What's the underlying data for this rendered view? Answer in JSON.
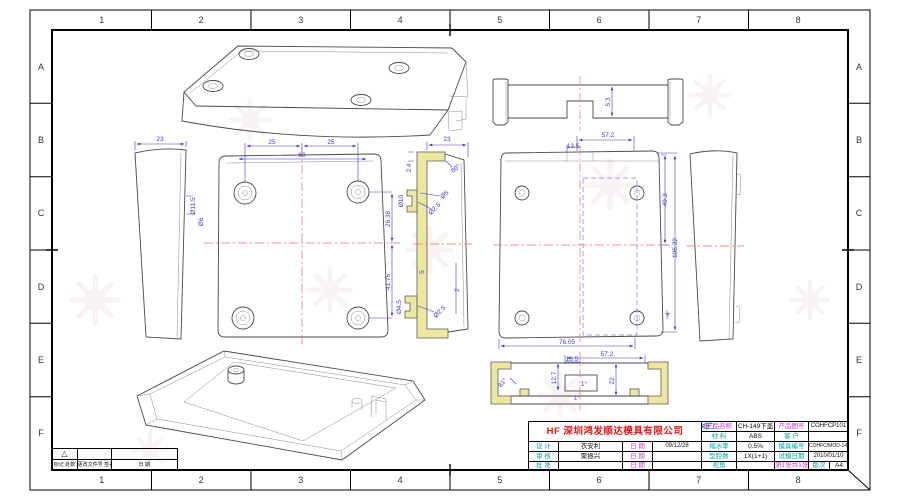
{
  "grid": {
    "cols": [
      "1",
      "2",
      "3",
      "4",
      "5",
      "6",
      "7",
      "8"
    ],
    "rows": [
      "A",
      "B",
      "C",
      "D",
      "E",
      "F"
    ]
  },
  "title_block": {
    "company": "HF 深圳鸿发顺达模具有限公司",
    "rows": [
      {
        "label": "设 计",
        "name": "衣安利",
        "date_label": "日 期",
        "date": "09/12/28"
      },
      {
        "label": "审 核",
        "name": "聚振兴",
        "date_label": "日 期",
        "date": ""
      },
      {
        "label": "批 准",
        "name": "",
        "date_label": "日 期",
        "date": ""
      }
    ],
    "product_name_label": "产品名称",
    "product_name": "CH-149下盖",
    "product_no_label": "产品图号",
    "product_no": "COHFCP101",
    "material_label": "材 料",
    "material": "ABS",
    "customer_label": "客 户",
    "customer": "",
    "shrinkage_label": "缩水率",
    "shrinkage": "0.5%",
    "mold_no_label": "模具编号",
    "mold_no": "COHFC/MOD-149",
    "cavity_label": "型腔数",
    "cavity": "1X(1+1)",
    "trial_label": "试模日期",
    "trial_date": "2010/01/10",
    "view_label": "视角",
    "sheet": "第1张共1张",
    "rev_label": "版次",
    "paper": "A4",
    "icons": {
      "view_angle_symbols": [
        "circle-cross",
        "truncated-cone-side"
      ]
    }
  },
  "revision_block": {
    "triangle": "△",
    "c1": "标记 处数",
    "c2": "更改文件号 签名",
    "c3": "日 期"
  },
  "dims": {
    "side_left": {
      "w": "23",
      "h1": "Ø11.5",
      "h2": "Ø6"
    },
    "plan_left": {
      "t1": "25",
      "t2": "25",
      "t3": "60",
      "r1": "26.38",
      "r2": "41.75"
    },
    "section_side": {
      "w": "23",
      "t": "2.4",
      "a": "60°",
      "p1": "Ø10",
      "p2": "Ø2.5",
      "p3": "Ø5",
      "m1": "5",
      "m2": "2",
      "b1": "Ø4.5",
      "b2": "Ø2.5"
    },
    "elev_top": {
      "h": "5.3"
    },
    "plan_right": {
      "t1": "57.2",
      "t2": "13.5",
      "r1": "49.3",
      "r2": "105.32",
      "b1": "76.05",
      "b2": "4"
    },
    "section_front": {
      "t1": "57.2",
      "t2": "13.5",
      "l1": "12.7",
      "c1": "1°",
      "c2": "1°",
      "a1": "81°",
      "r1": "22"
    }
  }
}
